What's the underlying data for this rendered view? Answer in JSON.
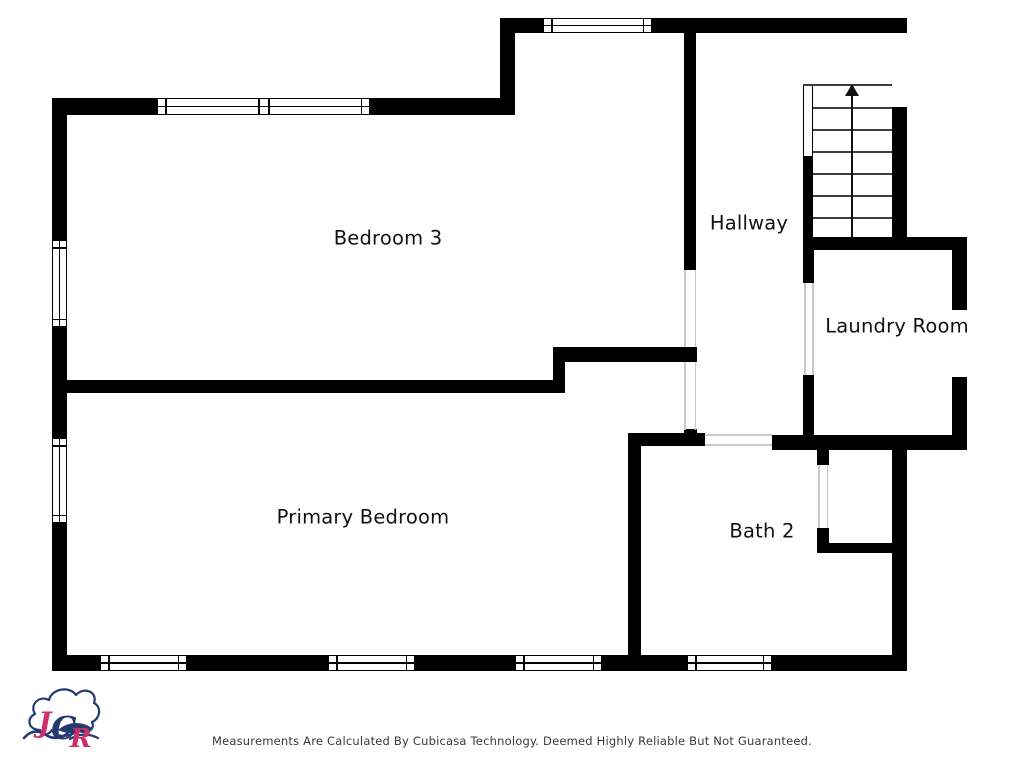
{
  "floorplan": {
    "rooms": [
      {
        "name": "Bedroom 3"
      },
      {
        "name": "Hallway"
      },
      {
        "name": "Laundry Room"
      },
      {
        "name": "Primary Bedroom"
      },
      {
        "name": "Bath 2"
      }
    ],
    "stairs": {
      "direction": "up",
      "tread_count": 7
    },
    "colors": {
      "wall": "#000000",
      "opening_line": "#c9c9c9",
      "stair_line": "#3d3d3d",
      "label_text": "#111111"
    }
  },
  "footer": {
    "disclaimer": "Measurements Are Calculated By Cubicasa Technology. Deemed Highly Reliable But Not Guaranteed."
  },
  "logo": {
    "letters": [
      "J",
      "C",
      "R"
    ],
    "colors": {
      "navy": "#233a73",
      "pink": "#cf2f68"
    }
  }
}
